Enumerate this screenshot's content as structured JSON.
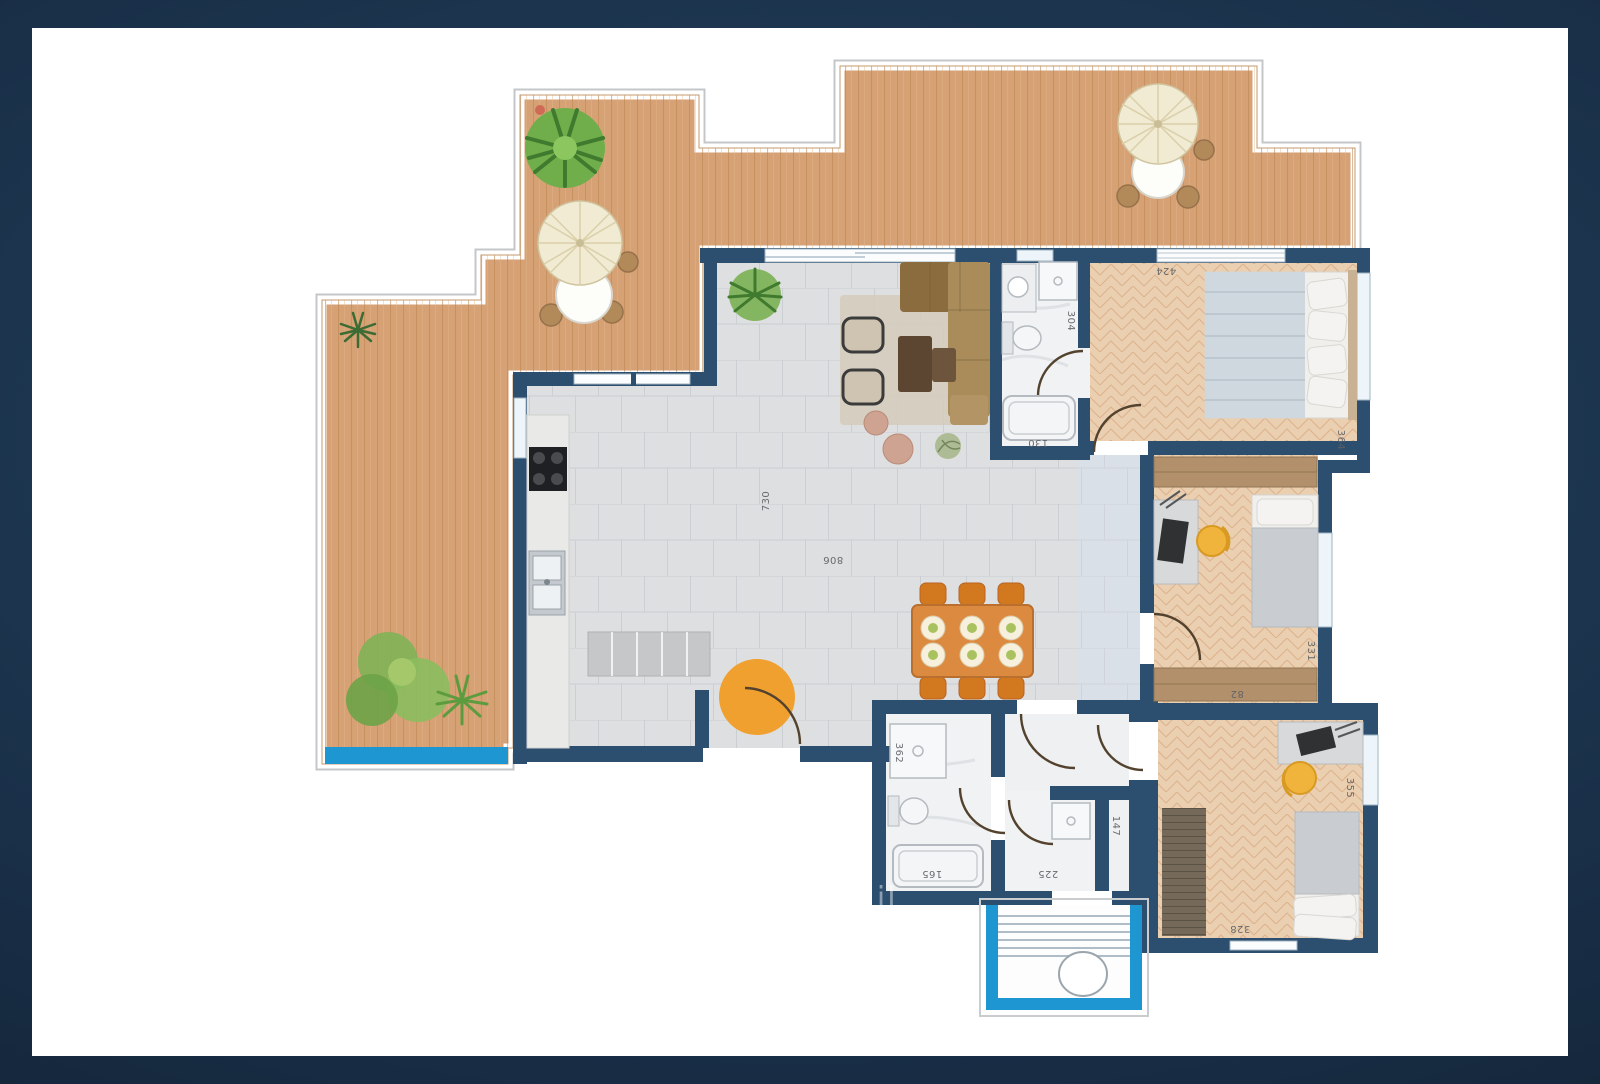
{
  "scene": {
    "type": "apartment-floor-plan",
    "background_color": "#1a3049",
    "canvas_color": "#ffffff",
    "wall_color": "#2c4e6f",
    "deck_wood_color": "#d6a174",
    "bedroom_wood_color": "#eacfb0",
    "tile_color": "#dedfe1",
    "pool_accent_color": "#1e96d2",
    "entrance_accent_color": "#1e96d2",
    "orange_accent_color": "#efa02e",
    "watermark": "o il"
  },
  "dimensions": [
    {
      "name": "living-depth",
      "value": "730"
    },
    {
      "name": "living-width",
      "value": "806"
    },
    {
      "name": "bathroom-top-depth",
      "value": "304"
    },
    {
      "name": "bathroom-top-width",
      "value": "130"
    },
    {
      "name": "bedroom1-width",
      "value": "424"
    },
    {
      "name": "bedroom1-depth",
      "value": "364"
    },
    {
      "name": "bedroom2-depth",
      "value": "331"
    },
    {
      "name": "bedroom2-wardrobe",
      "value": "82"
    },
    {
      "name": "bedroom3-depth",
      "value": "355"
    },
    {
      "name": "hallway-depth",
      "value": "147"
    },
    {
      "name": "shower-room-width",
      "value": "225"
    },
    {
      "name": "bathroom2-width",
      "value": "165"
    },
    {
      "name": "bathroom2-depth",
      "value": "362"
    },
    {
      "name": "bedroom3-width",
      "value": "328"
    }
  ]
}
